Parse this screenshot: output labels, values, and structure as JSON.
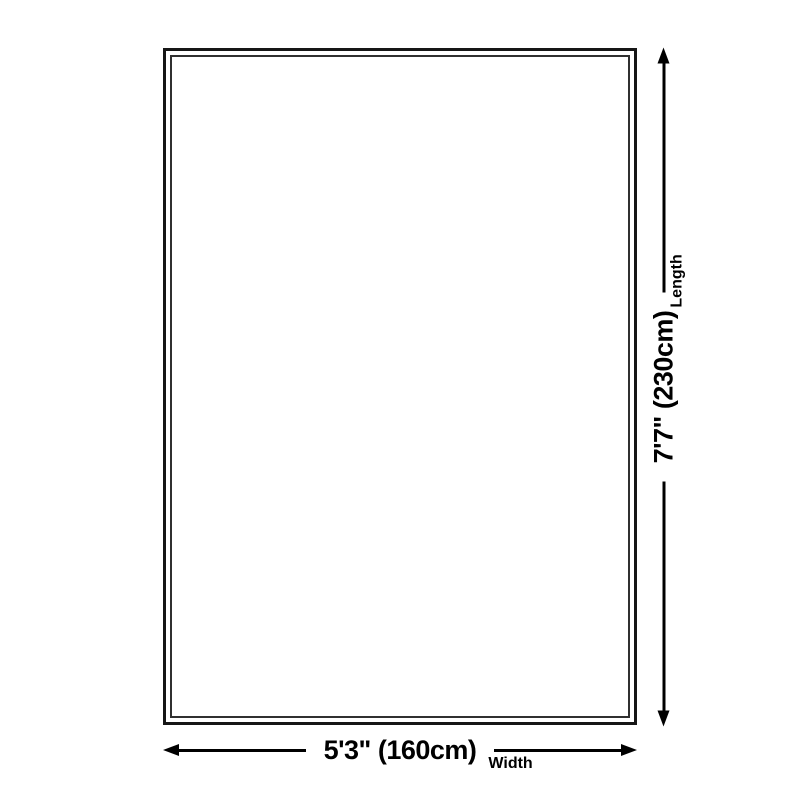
{
  "dimensions": {
    "length": {
      "label": "Length",
      "value": "7'7\" (230cm)"
    },
    "width": {
      "label": "Width",
      "value": "5'3\" (160cm)"
    }
  },
  "colors": {
    "background": "#ffffff",
    "line": "#000000",
    "text": "#000000",
    "border_outer": "#161616",
    "border_inner": "#303030"
  }
}
